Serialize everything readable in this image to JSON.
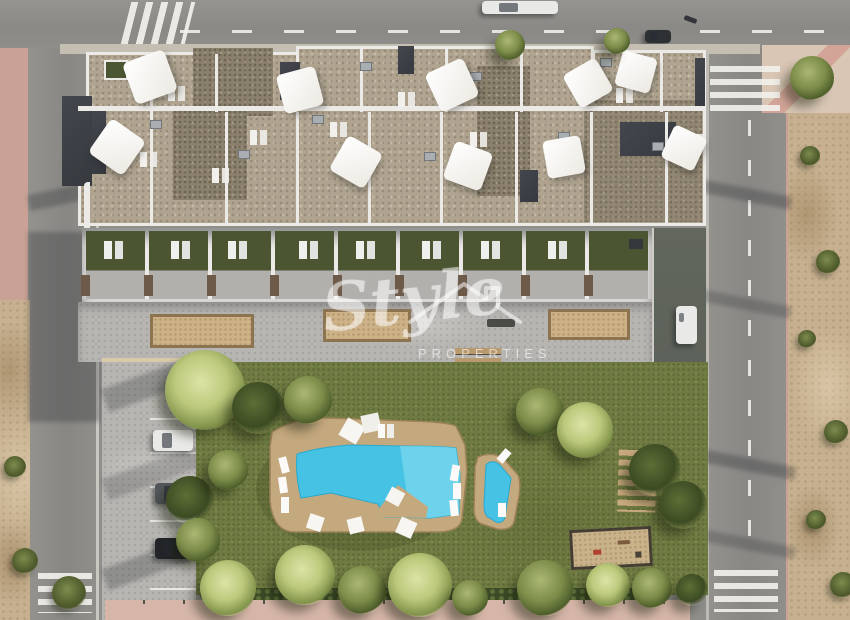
{
  "watermark": {
    "brand": "Style",
    "sub": "PROPERTIES"
  },
  "palette": {
    "road": "#908e8b",
    "sidewalk_pink": "#c9a195",
    "sand": "#c6b08f",
    "lawn": "#6f7b42",
    "turf": "#4b5531",
    "roof_gravel": "#b0a490",
    "roof_gravel_dark": "#8b806c",
    "building_white": "#eceae6",
    "charcoal": "#363a3f",
    "promenade": "#b7b5b1",
    "planter_fill": "#cdb187",
    "planter_edge": "#8d7450",
    "pool_water": "#46c2e4",
    "pool_water_light": "#7ed8ee",
    "pool_deck": "#c4a87e",
    "hedge": "#3d4a26",
    "walkway_pink": "#d6b6a8",
    "driveway": "#5d625a",
    "car_white": "#e9e9e7",
    "car_gray": "#53565a",
    "car_black": "#232528"
  }
}
